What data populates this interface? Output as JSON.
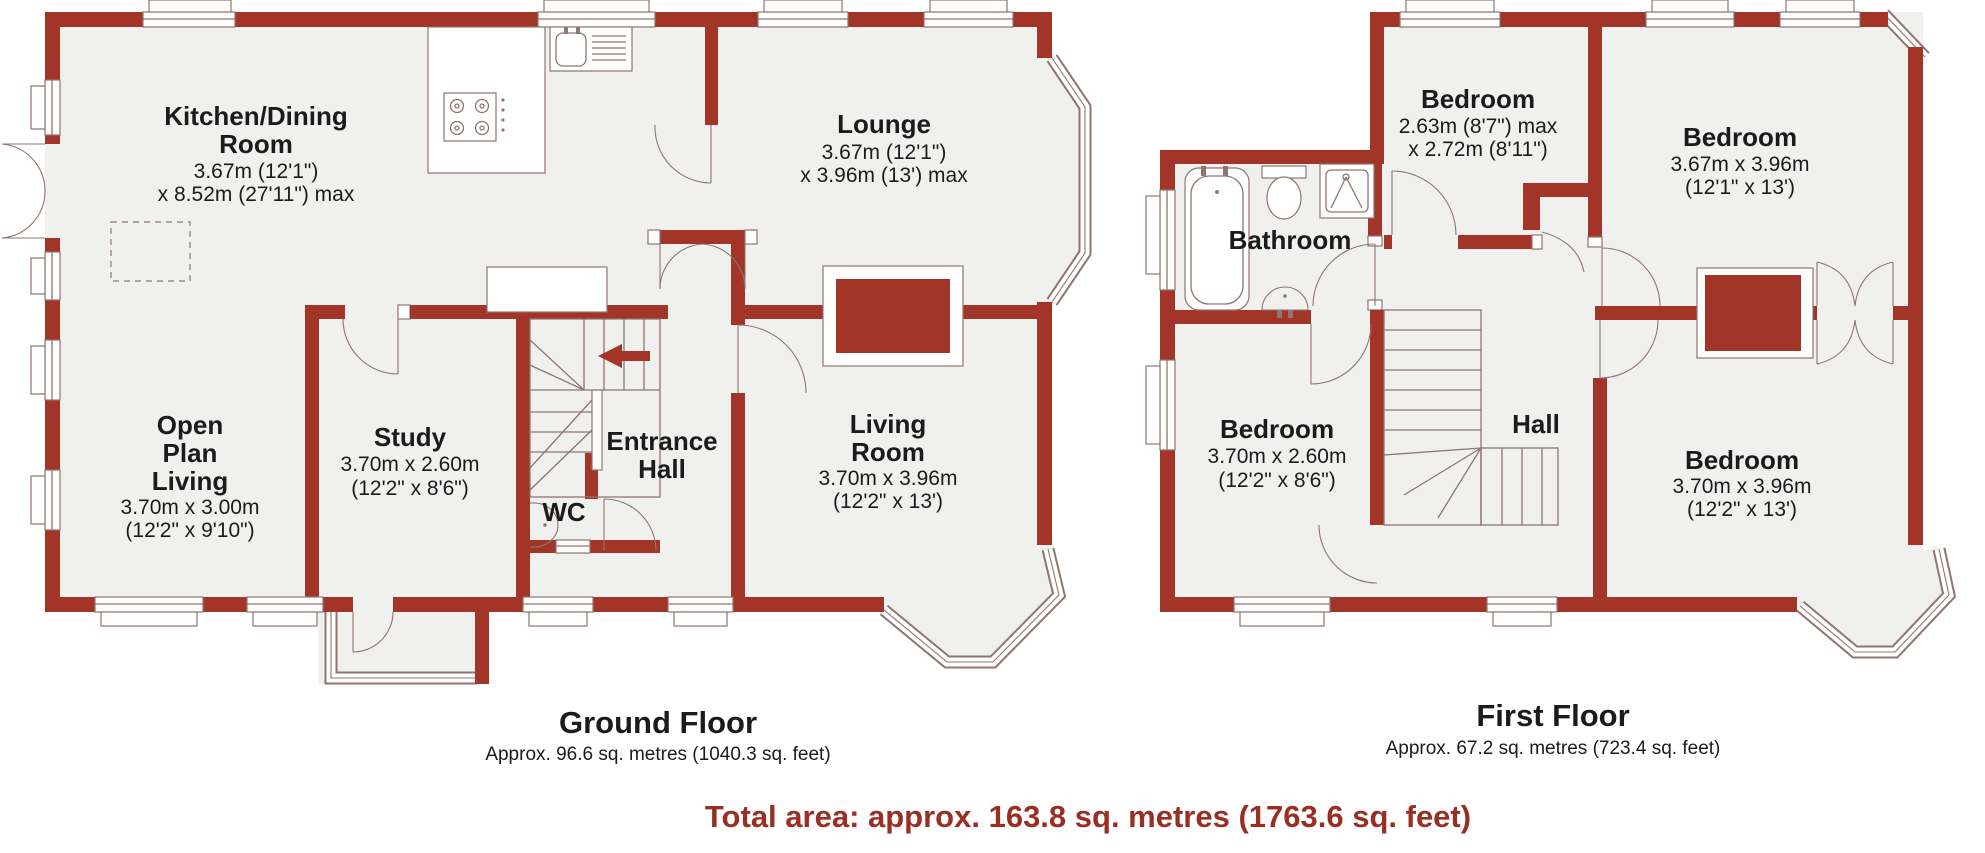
{
  "colors": {
    "wall": "#A33428",
    "room_fill": "#F0F0EE",
    "outline": "#8F7570",
    "text": "#1b1b1b",
    "accent_text": "#992E23",
    "background": "#FFFFFF"
  },
  "ground_floor": {
    "title": "Ground Floor",
    "subtitle": "Approx. 96.6 sq. metres (1040.3 sq. feet)",
    "rooms": {
      "kitchen_dining": {
        "name": [
          "Kitchen/Dining",
          "Room"
        ],
        "dims": [
          "3.67m (12'1\")",
          "x 8.52m (27'11\") max"
        ]
      },
      "lounge": {
        "name": [
          "Lounge"
        ],
        "dims": [
          "3.67m (12'1\")",
          "x 3.96m (13') max"
        ]
      },
      "open_plan_living": {
        "name": [
          "Open",
          "Plan",
          "Living"
        ],
        "dims": [
          "3.70m x 3.00m",
          "(12'2\" x 9'10\")"
        ]
      },
      "study": {
        "name": [
          "Study"
        ],
        "dims": [
          "3.70m x 2.60m",
          "(12'2\" x 8'6\")"
        ]
      },
      "entrance_hall": {
        "name": [
          "Entrance",
          "Hall"
        ],
        "dims": []
      },
      "wc": {
        "name": [
          "WC"
        ],
        "dims": []
      },
      "living_room": {
        "name": [
          "Living",
          "Room"
        ],
        "dims": [
          "3.70m x 3.96m",
          "(12'2\" x 13')"
        ]
      }
    }
  },
  "first_floor": {
    "title": "First Floor",
    "subtitle": "Approx. 67.2 sq. metres (723.4 sq. feet)",
    "rooms": {
      "bedroom_1": {
        "name": [
          "Bedroom"
        ],
        "dims": [
          "2.63m (8'7\") max",
          "x 2.72m (8'11\")"
        ]
      },
      "bedroom_2": {
        "name": [
          "Bedroom"
        ],
        "dims": [
          "3.67m x 3.96m",
          "(12'1\" x 13')"
        ]
      },
      "bathroom": {
        "name": [
          "Bathroom"
        ],
        "dims": []
      },
      "bedroom_3": {
        "name": [
          "Bedroom"
        ],
        "dims": [
          "3.70m x 2.60m",
          "(12'2\" x 8'6\")"
        ]
      },
      "hall": {
        "name": [
          "Hall"
        ],
        "dims": []
      },
      "bedroom_4": {
        "name": [
          "Bedroom"
        ],
        "dims": [
          "3.70m x 3.96m",
          "(12'2\" x 13')"
        ]
      }
    }
  },
  "total_area": "Total area: approx. 163.8 sq. metres (1763.6 sq. feet)"
}
